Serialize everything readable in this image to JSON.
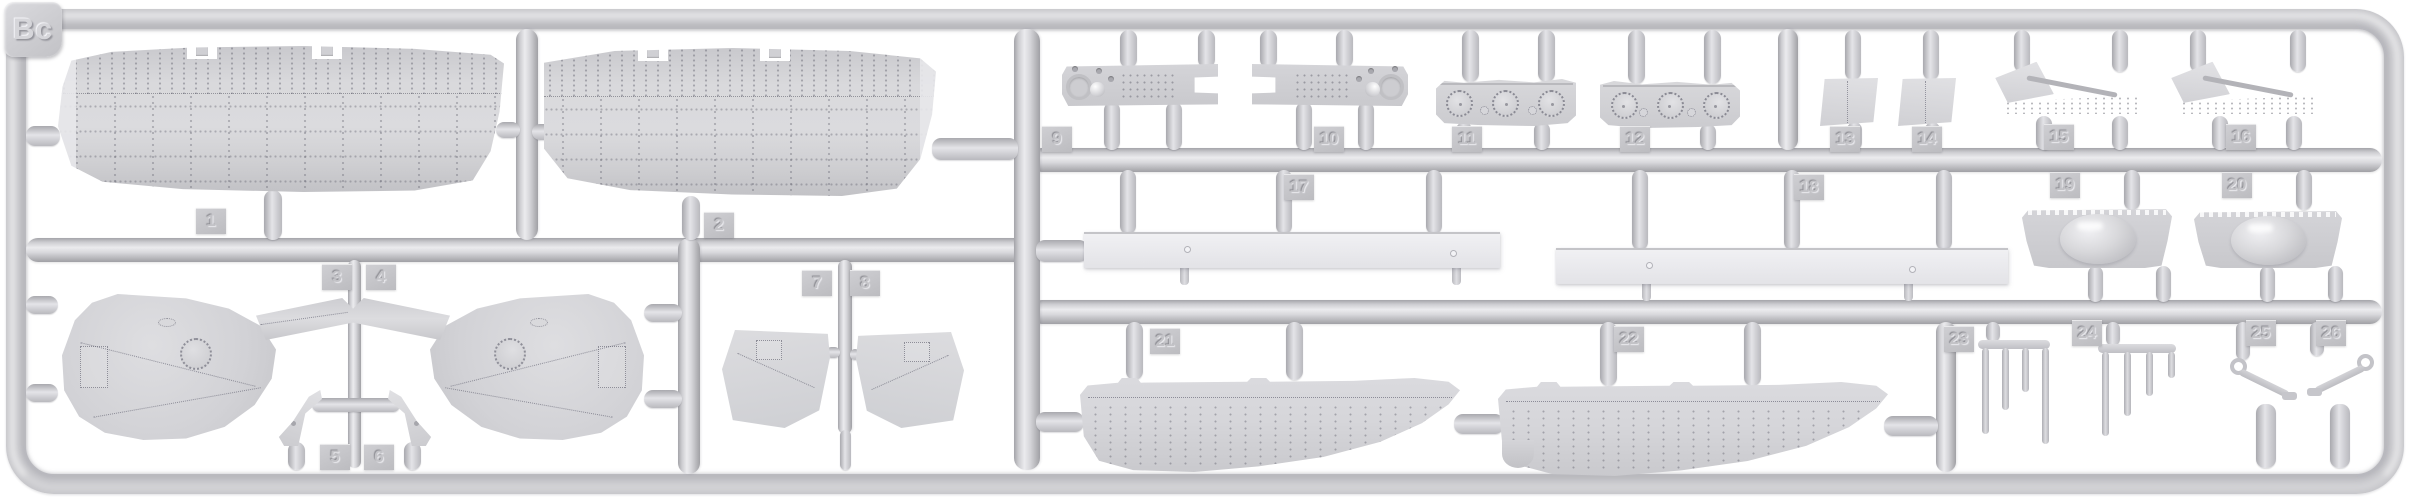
{
  "sprue": {
    "label": "Bc",
    "part_numbers": [
      "1",
      "2",
      "3",
      "4",
      "5",
      "6",
      "7",
      "8",
      "9",
      "10",
      "11",
      "12",
      "13",
      "14",
      "15",
      "16",
      "17",
      "18",
      "19",
      "20",
      "21",
      "22",
      "23",
      "24",
      "25",
      "26"
    ],
    "parts": [
      {
        "number": "1",
        "name": "upper-wing-half-left"
      },
      {
        "number": "2",
        "name": "upper-wing-half-right"
      },
      {
        "number": "3",
        "name": "gun-position-fairing-left"
      },
      {
        "number": "4",
        "name": "gun-position-fairing-right"
      },
      {
        "number": "5",
        "name": "fin-strut-left"
      },
      {
        "number": "6",
        "name": "fin-strut-right"
      },
      {
        "number": "7",
        "name": "cockpit-side-panel-left"
      },
      {
        "number": "8",
        "name": "cockpit-side-panel-right"
      },
      {
        "number": "9",
        "name": "instrument-panel-left"
      },
      {
        "number": "10",
        "name": "instrument-panel-right"
      },
      {
        "number": "11",
        "name": "porthole-panel-1"
      },
      {
        "number": "12",
        "name": "porthole-panel-2"
      },
      {
        "number": "13",
        "name": "flat-panel-1"
      },
      {
        "number": "14",
        "name": "flat-panel-2"
      },
      {
        "number": "15",
        "name": "wing-strut-assembly-1"
      },
      {
        "number": "16",
        "name": "wing-strut-assembly-2"
      },
      {
        "number": "17",
        "name": "spar-plank-1"
      },
      {
        "number": "18",
        "name": "spar-plank-2"
      },
      {
        "number": "19",
        "name": "dome-fairing-1"
      },
      {
        "number": "20",
        "name": "dome-fairing-2"
      },
      {
        "number": "21",
        "name": "hull-bottom-half-1"
      },
      {
        "number": "22",
        "name": "hull-bottom-half-2"
      },
      {
        "number": "23",
        "name": "strut-comb-1"
      },
      {
        "number": "24",
        "name": "strut-comb-2"
      },
      {
        "number": "25",
        "name": "control-bracket-left"
      },
      {
        "number": "26",
        "name": "control-bracket-right"
      }
    ],
    "colors": {
      "background": "#ffffff",
      "plastic": "#cfcfd3",
      "plastic_highlight": "#ebebee",
      "plastic_shadow": "#9e9ea4",
      "tag": "#c4c4c8"
    }
  }
}
